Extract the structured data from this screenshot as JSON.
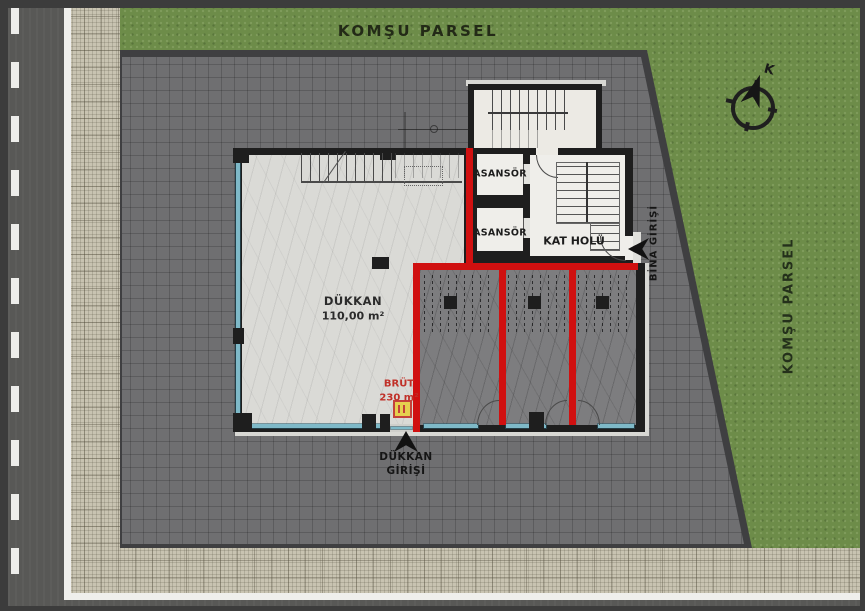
{
  "site": {
    "neighbor_parcel_top": "KOMŞU PARSEL",
    "neighbor_parcel_right": "KOMŞU PARSEL",
    "compass_letter": "K"
  },
  "building": {
    "elevator_1": "ASANSÖR",
    "elevator_2": "ASANSÖR",
    "floor_hall": "KAT HOLÜ",
    "shop_name": "DÜKKAN",
    "shop_area": "110,00 m²",
    "gross_label": "BRÜT",
    "gross_area": "230 m²"
  },
  "entrances": {
    "shop_line1": "DÜKKAN",
    "shop_line2": "GİRİŞİ",
    "building": "BİNA GİRİŞİ"
  },
  "colors": {
    "highlight_wall_red": "#d01010",
    "wall_black": "#1e1e1e",
    "glass_teal": "#7eb9c8",
    "grass_green": "#6d8c49",
    "parcel_pavement": "#6f6f71",
    "sidewalk_beige": "#c8c3b1",
    "road_asphalt": "#585856",
    "shop_floor": "#dadad6",
    "unit_floor": "#7d7d7f",
    "gross_text_red": "#c03028",
    "marker_yellow": "#e6cf4e"
  },
  "icons": {
    "north_arrow": "compass-north-arrow",
    "shop_entrance_arrow": "up-arrow",
    "building_entrance_arrow": "left-arrow",
    "utility_marker": "yellow-square-marker"
  }
}
